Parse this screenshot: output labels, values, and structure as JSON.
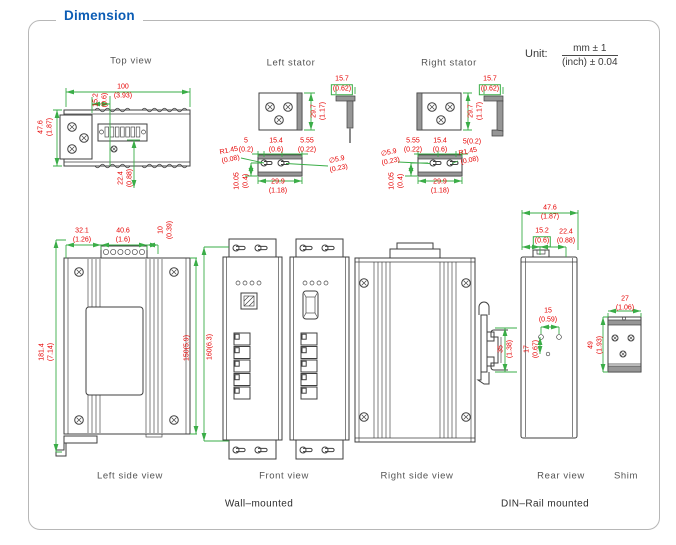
{
  "title": "Dimension",
  "unit": {
    "prefix": "Unit:",
    "numerator": "mm ± 1",
    "denominator": "(inch) ± 0.04"
  },
  "footers": {
    "wall": "Wall–mounted",
    "din": "DIN–Rail mounted"
  },
  "views": {
    "top": {
      "label": "Top view",
      "dims": {
        "width": [
          "100",
          "(3.93)"
        ],
        "offset": [
          "15.2",
          "(0.6)"
        ],
        "height": [
          "47.6",
          "(1.87)"
        ],
        "bottom": [
          "22.4",
          "(0.88)"
        ]
      }
    },
    "left_stator": {
      "label": "Left stator",
      "dims": {
        "plate_h": [
          "29.7",
          "(1.17)"
        ],
        "thk": [
          "15.7",
          "(0.62)"
        ],
        "d5": [
          "5",
          "(0.2)"
        ],
        "d154": [
          "15.4",
          "(0.6)"
        ],
        "d555": [
          "5.55",
          "(0.22)"
        ],
        "r145": [
          "R1.45",
          "(0.08)"
        ],
        "dia59": [
          "∅5.9",
          "(0.23)"
        ],
        "d1005": [
          "10.05",
          "(0.4)"
        ],
        "d299": [
          "29.9",
          "(1.18)"
        ]
      }
    },
    "right_stator": {
      "label": "Right stator",
      "dims": {
        "plate_h": [
          "29.7",
          "(1.17)"
        ],
        "thk": [
          "15.7",
          "(0.62)"
        ],
        "d555": [
          "5.55",
          "(0.22)"
        ],
        "d154": [
          "15.4",
          "(0.6)"
        ],
        "d5": "5(0.2)",
        "r145": [
          "R1.45",
          "(0.08)"
        ],
        "dia59": [
          "∅5.9",
          "(0.23)"
        ],
        "d1005": [
          "10.05",
          "(0.4)"
        ],
        "d299": [
          "29.9",
          "(1.18)"
        ]
      }
    },
    "left_side": {
      "label": "Left side view",
      "dims": {
        "d321": [
          "32.1",
          "(1.26)"
        ],
        "d406": [
          "40.6",
          "(1.6)"
        ],
        "d10": [
          "10",
          "(0.39)"
        ],
        "total_h": [
          "181.4",
          "(7.14)"
        ],
        "body_h": "150(5.9)"
      }
    },
    "front": {
      "label": "Front view",
      "dims": {
        "h": "160(6.3)"
      }
    },
    "right_side": {
      "label": "Right side view"
    },
    "rear": {
      "label": "Rear view",
      "dims": {
        "w": [
          "47.6",
          "(1.87)"
        ],
        "d152": [
          "15.2",
          "(0.6)"
        ],
        "d224": [
          "22.4",
          "(0.88)"
        ],
        "d15": [
          "15",
          "(0.59)"
        ],
        "d17": [
          "17",
          "(0.67)"
        ],
        "d35": [
          "35",
          "(1.38)"
        ]
      }
    },
    "shim": {
      "label": "Shim",
      "dims": {
        "w": [
          "27",
          "(1.06)"
        ],
        "h": [
          "49",
          "(1.93)"
        ]
      }
    }
  }
}
